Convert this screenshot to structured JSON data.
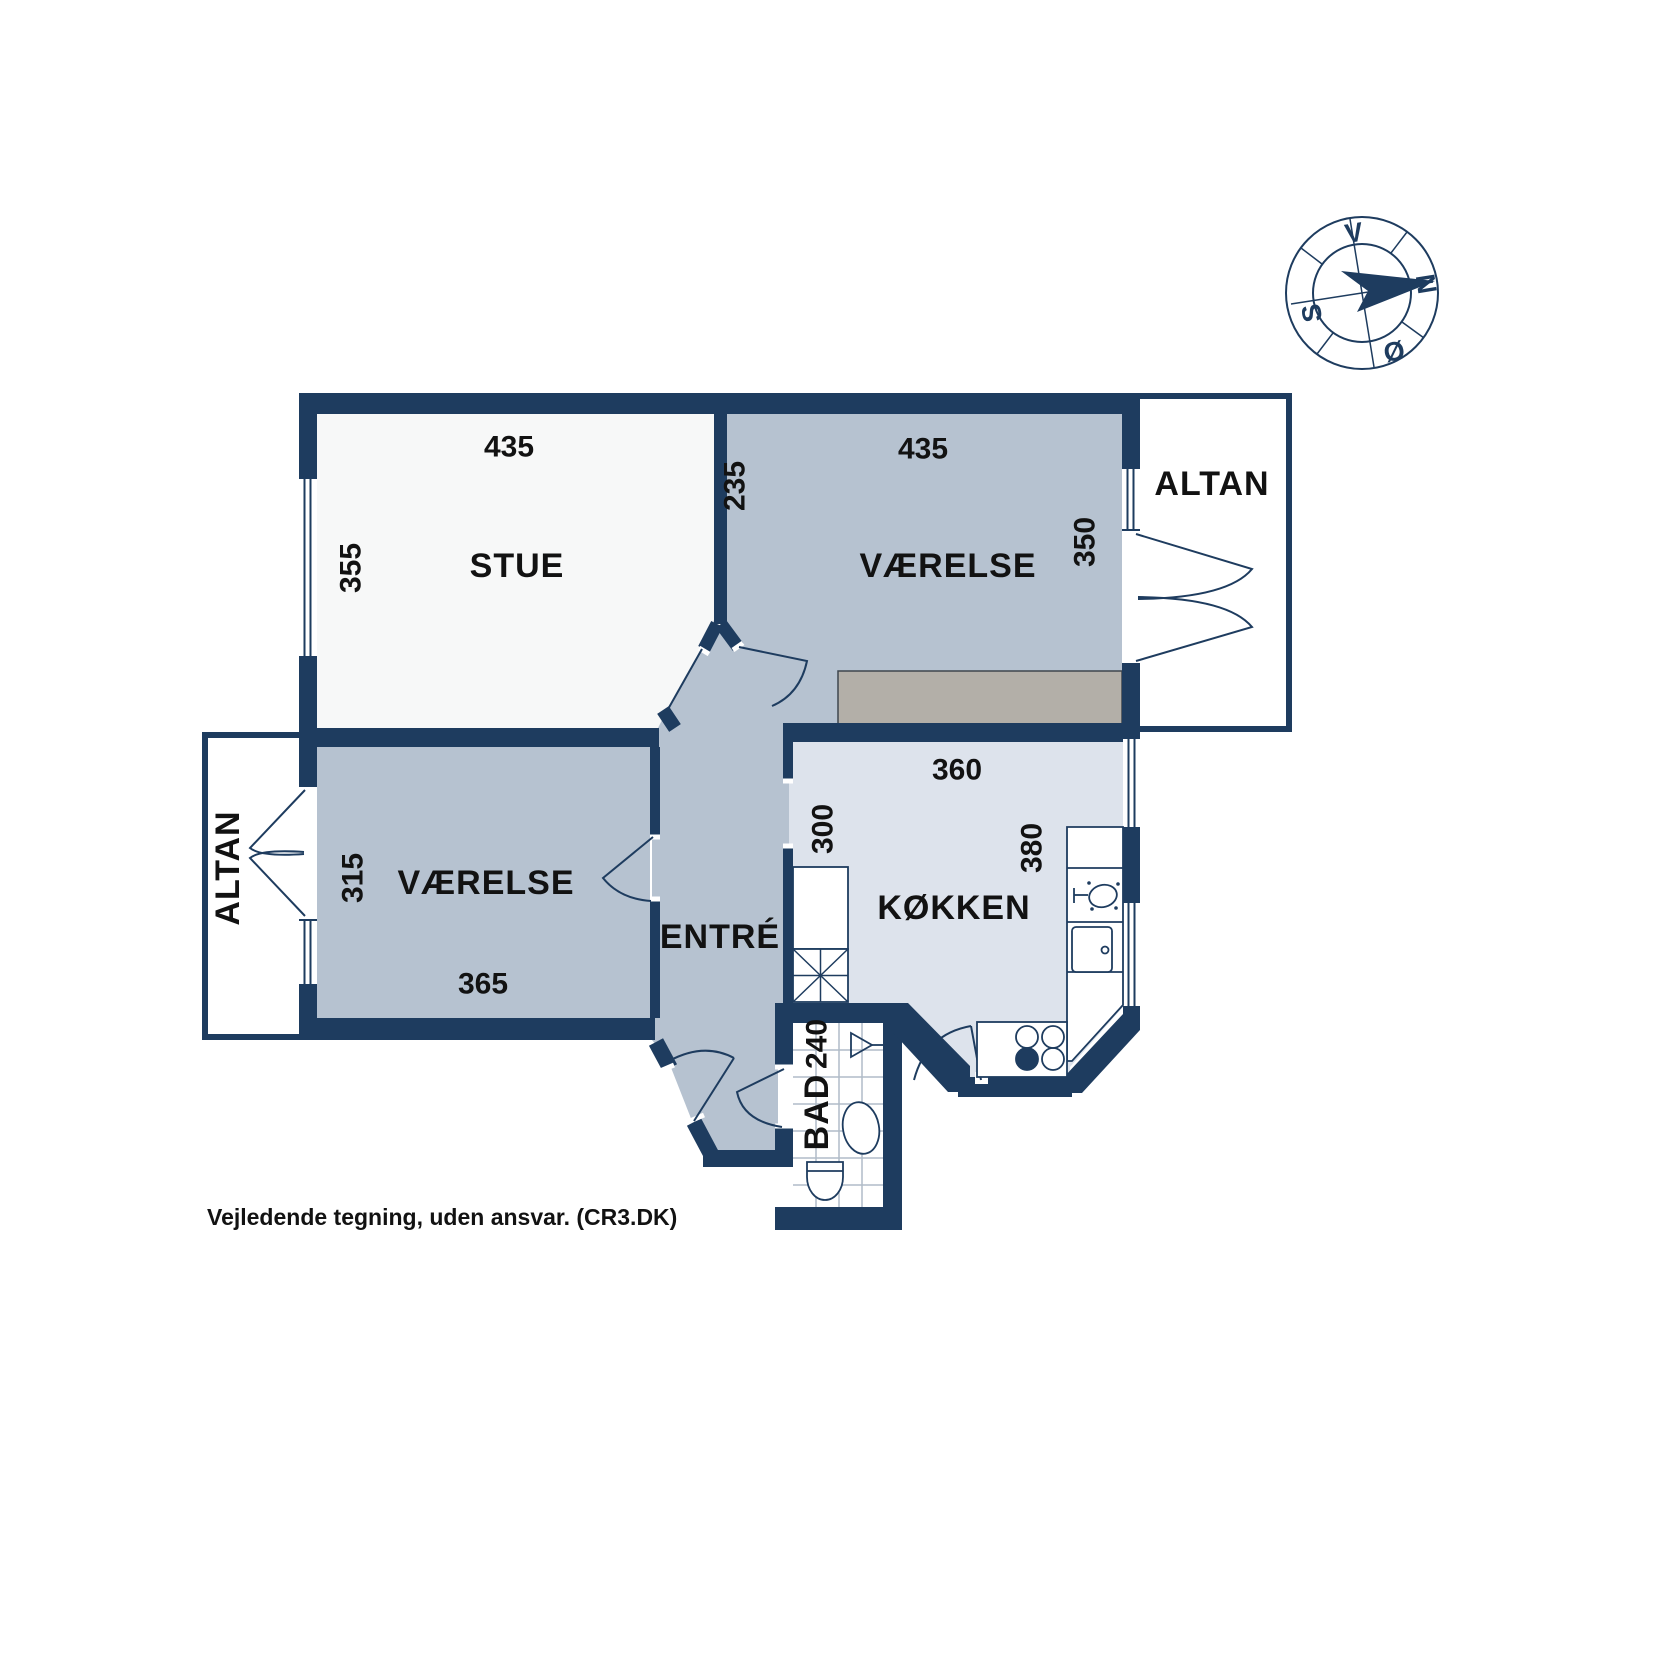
{
  "plan": {
    "rooms": {
      "stue": {
        "label": "STUE",
        "width": "435",
        "height": "355"
      },
      "vaerelse_ne": {
        "label": "VÆRELSE",
        "width": "435",
        "height": "350",
        "inner": "235"
      },
      "vaerelse_w": {
        "label": "VÆRELSE",
        "width": "365",
        "height": "315"
      },
      "entre": {
        "label": "ENTRÉ"
      },
      "koekken": {
        "label": "KØKKEN",
        "width": "360",
        "height": "380",
        "left": "300"
      },
      "bad": {
        "label": "BAD",
        "width": "240"
      },
      "altan_ne": {
        "label": "ALTAN"
      },
      "altan_w": {
        "label": "ALTAN"
      }
    },
    "compass": {
      "north": "N",
      "west": "V",
      "south": "S",
      "east": "Ø"
    },
    "disclaimer": "Vejledende tegning, uden ansvar. (CR3.DK)",
    "colors": {
      "wall": "#1e3c5f",
      "room_blue": "#b6c2d0",
      "kitchen": "#dde3ec",
      "stue": "#f7f8f8",
      "wardrobe": "#b3afa8",
      "tile_line": "#b0bcc8",
      "text": "#121212"
    }
  }
}
